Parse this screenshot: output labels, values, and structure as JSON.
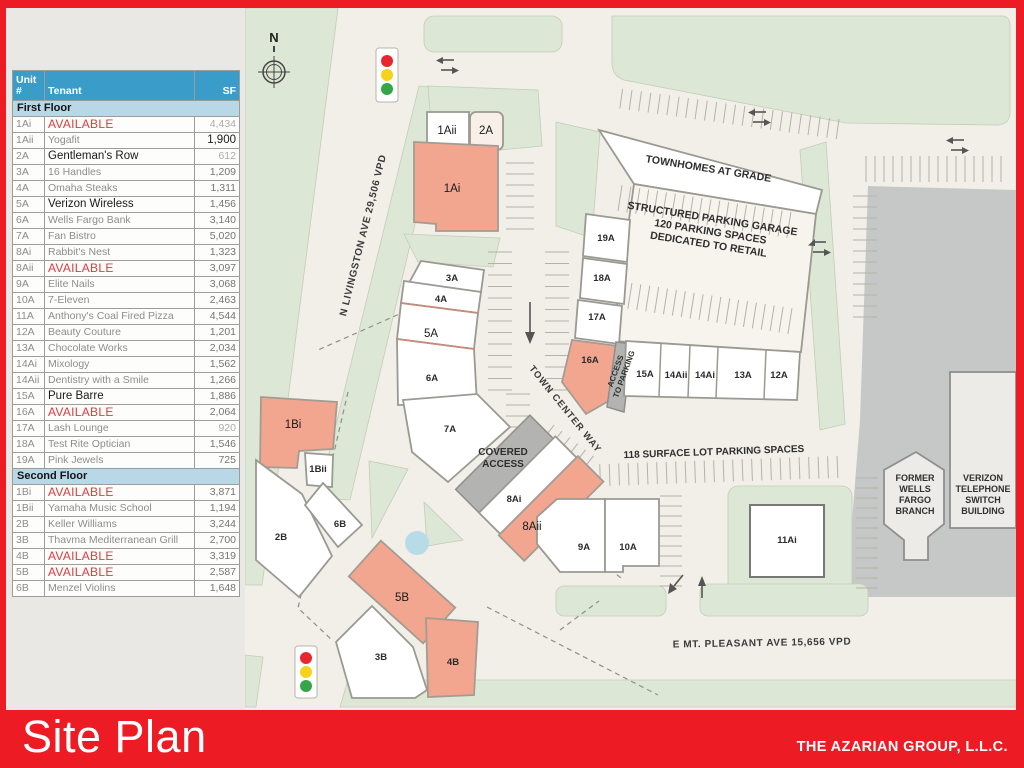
{
  "footer": {
    "title": "Site Plan",
    "company": "THE AZARIAN GROUP, L.L.C."
  },
  "colors": {
    "accent_red": "#ed1c24",
    "table_header_blue": "#3a9cc8",
    "table_section_blue": "#b8d8e8",
    "available_red": "#e1393e",
    "available_fill": "#f3a68f",
    "green_landscape": "#dde7d5"
  },
  "table": {
    "headers": {
      "unit": "Unit #",
      "tenant": "Tenant",
      "sf": "SF"
    },
    "sections": [
      {
        "label": "First Floor",
        "rows": [
          [
            "1Ai",
            "AVAILABLE",
            "4,434",
            "avail",
            "muted"
          ],
          [
            "1Aii",
            "Yogafit",
            "1,900",
            "normal",
            "strong"
          ],
          [
            "2A",
            "Gentleman's Row",
            "612",
            "alt",
            "muted"
          ],
          [
            "3A",
            "16 Handles",
            "1,209",
            "normal",
            ""
          ],
          [
            "4A",
            "Omaha Steaks",
            "1,311",
            "normal",
            ""
          ],
          [
            "5A",
            "Verizon Wireless",
            "1,456",
            "alt",
            ""
          ],
          [
            "6A",
            "Wells Fargo Bank",
            "3,140",
            "normal",
            ""
          ],
          [
            "7A",
            "Fan Bistro",
            "5,020",
            "normal",
            ""
          ],
          [
            "8Ai",
            "Rabbit's Nest",
            "1,323",
            "normal",
            ""
          ],
          [
            "8Aii",
            "AVAILABLE",
            "3,097",
            "avail",
            ""
          ],
          [
            "9A",
            "Elite Nails",
            "3,068",
            "normal",
            ""
          ],
          [
            "10A",
            "7-Eleven",
            "2,463",
            "normal",
            ""
          ],
          [
            "11A",
            "Anthony's Coal Fired Pizza",
            "4,544",
            "normal",
            ""
          ],
          [
            "12A",
            "Beauty Couture",
            "1,201",
            "normal",
            ""
          ],
          [
            "13A",
            "Chocolate Works",
            "2,034",
            "normal",
            ""
          ],
          [
            "14Ai",
            "Mixology",
            "1,562",
            "normal",
            ""
          ],
          [
            "14Aii",
            "Dentistry with a Smile",
            "1,266",
            "normal",
            ""
          ],
          [
            "15A",
            "Pure Barre",
            "1,886",
            "alt",
            ""
          ],
          [
            "16A",
            "AVAILABLE",
            "2,064",
            "avail",
            ""
          ],
          [
            "17A",
            "Lash Lounge",
            "920",
            "normal",
            "muted"
          ],
          [
            "18A",
            "Test Rite Optician",
            "1,546",
            "normal",
            ""
          ],
          [
            "19A",
            "Pink Jewels",
            "725",
            "normal",
            ""
          ]
        ]
      },
      {
        "label": "Second Floor",
        "rows": [
          [
            "1Bi",
            "AVAILABLE",
            "3,871",
            "avail",
            ""
          ],
          [
            "1Bii",
            "Yamaha Music School",
            "1,194",
            "normal",
            ""
          ],
          [
            "2B",
            "Keller Williams",
            "3,244",
            "normal",
            ""
          ],
          [
            "3B",
            "Thavma Mediterranean Grill",
            "2,700",
            "normal",
            ""
          ],
          [
            "4B",
            "AVAILABLE",
            "3,319",
            "avail",
            ""
          ],
          [
            "5B",
            "AVAILABLE",
            "2,587",
            "avail",
            ""
          ],
          [
            "6B",
            "Menzel Violins",
            "1,648",
            "normal",
            ""
          ]
        ]
      }
    ]
  },
  "map": {
    "labels": [
      {
        "n": "compass-n-label",
        "t": "N",
        "x": 274,
        "y": 42,
        "c": "compass-n"
      },
      {
        "n": "street-livingston",
        "t": "N LIVINGSTON AVE  29,506 VPD",
        "x": 366,
        "y": 236,
        "r": -76,
        "c": "street"
      },
      {
        "n": "street-town-center-way",
        "t": "TOWN CENTER WAY",
        "x": 563,
        "y": 411,
        "r": 51,
        "c": "tcw"
      },
      {
        "n": "street-mt-pleasant",
        "t": "E MT. PLEASANT AVE  15,656 VPD",
        "x": 762,
        "y": 646,
        "r": -1,
        "c": "street"
      },
      {
        "n": "note-townhomes",
        "t": "TOWNHOMES AT GRADE",
        "x": 708,
        "y": 172,
        "r": 9,
        "c": "note"
      },
      {
        "n": "note-parking-garage",
        "l": [
          "STRUCTURED PARKING GARAGE",
          "120  PARKING SPACES",
          "DEDICATED TO RETAIL"
        ],
        "lh": 13,
        "x": 712,
        "y": 222,
        "r": 9,
        "c": "note"
      },
      {
        "n": "note-surface-lot",
        "t": "118 SURFACE LOT PARKING SPACES",
        "x": 714,
        "y": 455,
        "r": -2,
        "c": "note-sm"
      },
      {
        "n": "note-access-to-parking",
        "l": [
          "ACCESS",
          "TO PARKING"
        ],
        "lh": 9,
        "x": 618,
        "y": 372,
        "r": -70,
        "c": "tiny"
      },
      {
        "n": "note-covered-access",
        "l": [
          "COVERED",
          "ACCESS"
        ],
        "lh": 12,
        "x": 503,
        "y": 455,
        "c": "note-sm"
      },
      {
        "n": "note-former-wells-fargo",
        "l": [
          "FORMER",
          "WELLS",
          "FARGO",
          "BRANCH"
        ],
        "lh": 11,
        "x": 915,
        "y": 481,
        "c": "tiny2"
      },
      {
        "n": "note-verizon-building",
        "l": [
          "VERIZON",
          "TELEPHONE",
          "SWITCH",
          "BUILDING"
        ],
        "lh": 11,
        "x": 983,
        "y": 481,
        "c": "tiny2"
      },
      {
        "n": "label-unit-1Aii",
        "t": "1Aii",
        "x": 447,
        "y": 134,
        "c": "unit-big"
      },
      {
        "n": "label-unit-2A",
        "t": "2A",
        "x": 486,
        "y": 134,
        "c": "unit-big"
      },
      {
        "n": "label-unit-1Ai",
        "t": "1Ai",
        "x": 452,
        "y": 192,
        "c": "unit-big"
      },
      {
        "n": "label-unit-3A",
        "t": "3A",
        "x": 452,
        "y": 281,
        "c": "unit"
      },
      {
        "n": "label-unit-4A",
        "t": "4A",
        "x": 441,
        "y": 302,
        "c": "unit"
      },
      {
        "n": "label-unit-5A",
        "t": "5A",
        "x": 431,
        "y": 337,
        "c": "unit-big"
      },
      {
        "n": "label-unit-6A",
        "t": "6A",
        "x": 432,
        "y": 381,
        "c": "unit"
      },
      {
        "n": "label-unit-7A",
        "t": "7A",
        "x": 450,
        "y": 432,
        "c": "unit"
      },
      {
        "n": "label-unit-19A",
        "t": "19A",
        "x": 606,
        "y": 241,
        "c": "unit"
      },
      {
        "n": "label-unit-18A",
        "t": "18A",
        "x": 602,
        "y": 281,
        "c": "unit"
      },
      {
        "n": "label-unit-17A",
        "t": "17A",
        "x": 597,
        "y": 320,
        "c": "unit"
      },
      {
        "n": "label-unit-16A",
        "t": "16A",
        "x": 590,
        "y": 363,
        "c": "unit"
      },
      {
        "n": "label-unit-15A",
        "t": "15A",
        "x": 645,
        "y": 377,
        "c": "unit"
      },
      {
        "n": "label-unit-14Aii",
        "t": "14Aii",
        "x": 676,
        "y": 378,
        "c": "unit"
      },
      {
        "n": "label-unit-14Ai",
        "t": "14Ai",
        "x": 705,
        "y": 378,
        "c": "unit"
      },
      {
        "n": "label-unit-13A",
        "t": "13A",
        "x": 743,
        "y": 378,
        "c": "unit"
      },
      {
        "n": "label-unit-12A",
        "t": "12A",
        "x": 779,
        "y": 378,
        "c": "unit"
      },
      {
        "n": "label-unit-8Ai",
        "t": "8Ai",
        "x": 514,
        "y": 502,
        "c": "unit"
      },
      {
        "n": "label-unit-8Aii",
        "t": "8Aii",
        "x": 532,
        "y": 530,
        "c": "unit-big"
      },
      {
        "n": "label-unit-9A",
        "t": "9A",
        "x": 584,
        "y": 550,
        "c": "unit"
      },
      {
        "n": "label-unit-10A",
        "t": "10A",
        "x": 628,
        "y": 550,
        "c": "unit"
      },
      {
        "n": "label-unit-11Ai",
        "t": "11Ai",
        "x": 787,
        "y": 543,
        "c": "unit"
      },
      {
        "n": "label-unit-1Bi",
        "t": "1Bi",
        "x": 293,
        "y": 428,
        "c": "unit-big"
      },
      {
        "n": "label-unit-1Bii",
        "t": "1Bii",
        "x": 318,
        "y": 472,
        "c": "unit"
      },
      {
        "n": "label-unit-2B",
        "t": "2B",
        "x": 281,
        "y": 540,
        "c": "unit"
      },
      {
        "n": "label-unit-6B",
        "t": "6B",
        "x": 340,
        "y": 527,
        "c": "unit"
      },
      {
        "n": "label-unit-5B",
        "t": "5B",
        "x": 402,
        "y": 601,
        "c": "unit-big"
      },
      {
        "n": "label-unit-3B",
        "t": "3B",
        "x": 381,
        "y": 660,
        "c": "unit"
      },
      {
        "n": "label-unit-4B",
        "t": "4B",
        "x": 453,
        "y": 665,
        "c": "unit"
      }
    ]
  }
}
